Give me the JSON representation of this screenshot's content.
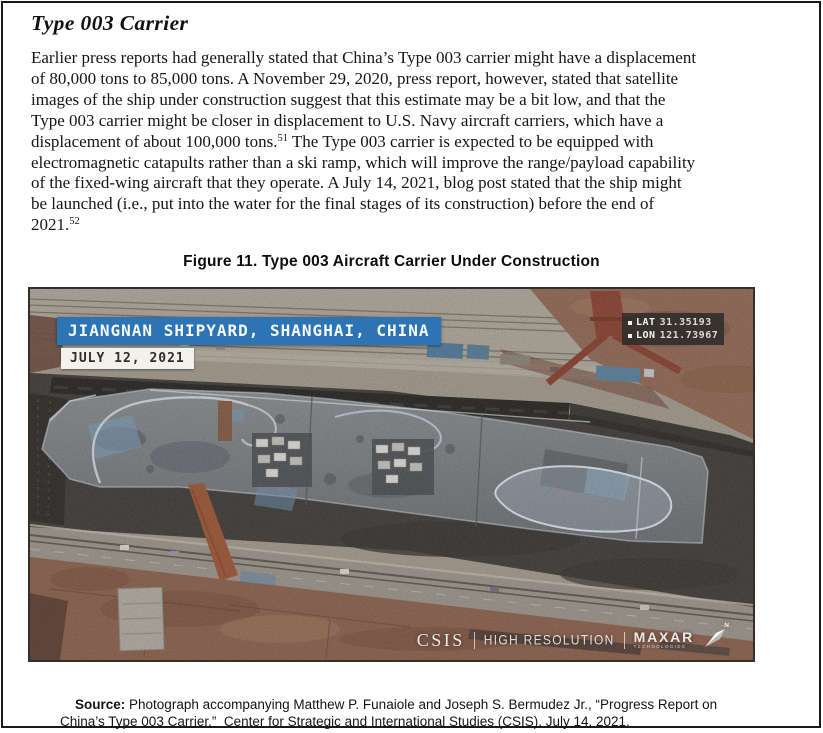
{
  "document": {
    "heading": "Type 003 Carrier",
    "paragraph_runs": [
      {
        "type": "text",
        "text": "Earlier press reports had generally stated that China’s Type 003 carrier might have a displacement\nof 80,000 tons to 85,000 tons. A November 29, 2020, press report, however, stated that satellite\nimages of the ship under construction suggest that this estimate may be a bit low, and that the\nType 003 carrier might be closer in displacement to U.S. Navy aircraft carriers, which have a\ndisplacement of about 100,000 tons."
      },
      {
        "type": "sup",
        "text": "51"
      },
      {
        "type": "text",
        "text": " The Type 003 carrier is expected to be equipped with\nelectromagnetic catapults rather than a ski ramp, which will improve the range/payload capability\nof the fixed-wing aircraft that they operate. A July 14, 2021, blog post stated that the ship might\nbe launched (i.e., put into the water for the final stages of its construction) before the end of\n2021."
      },
      {
        "type": "sup",
        "text": "52"
      }
    ],
    "figure_caption": "Figure 11. Type 003 Aircraft Carrier Under Construction",
    "source_label": "Source:",
    "source_text": " Photograph accompanying Matthew P. Funaiole and Joseph S. Bermudez Jr., “Progress Report on\nChina’s Type 003 Carrier,”  Center for Strategic and International Studies (CSIS), July 14, 2021."
  },
  "figure": {
    "location_banner": "JIANGNAN SHIPYARD, SHANGHAI, CHINA",
    "date_label": "JULY 12, 2021",
    "coordinates": {
      "lat_label": "LAT",
      "lat_value": "31.35193",
      "lon_label": "LON",
      "lon_value": "121.73967"
    },
    "watermark": {
      "org": "CSIS",
      "quality": "HIGH RESOLUTION",
      "provider": "MAXAR",
      "provider_sub": "TECHNOLOGIES"
    },
    "north_label": "N"
  },
  "colors": {
    "banner-blue": "#2d74b4",
    "banner-text": "#f4f9fd",
    "date-bg": "#f2f1ec",
    "date-text": "#2e2d2a",
    "coord-bg": "rgba(44,44,42,0.85)",
    "coord-text": "#f5f4ef",
    "watermark-text": "rgba(250,250,248,0.9)"
  }
}
